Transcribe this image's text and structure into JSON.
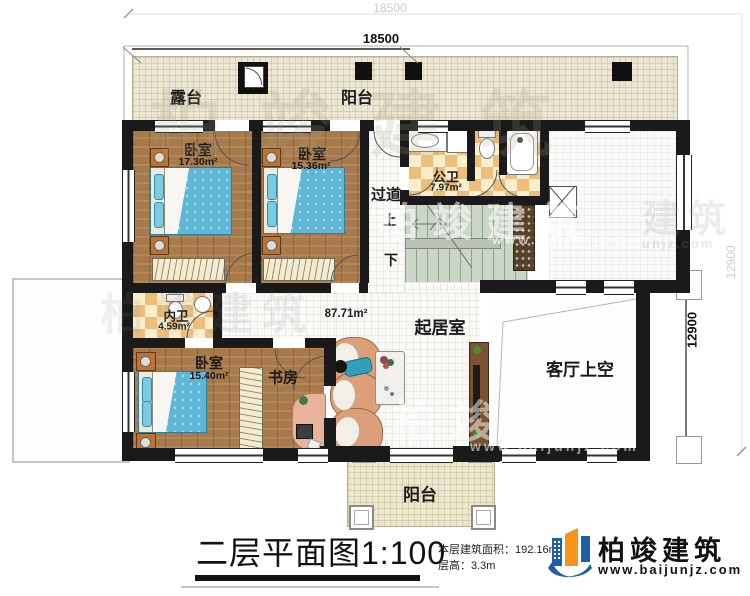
{
  "dimensions": {
    "top_outer": "18500",
    "top_inner": "18500",
    "right_outer": "12900",
    "right_inner": "12900"
  },
  "rooms": {
    "terrace": {
      "label": "露台"
    },
    "balcony_top": {
      "label": "阳台"
    },
    "bedroom1": {
      "label": "卧室",
      "area": "17.30m²"
    },
    "bedroom2": {
      "label": "卧室",
      "area": "15.36m²"
    },
    "public_bath": {
      "label": "公卫",
      "area": "7.97m²"
    },
    "corridor": {
      "label": "过道",
      "stairs_up": "上",
      "stairs_down": "下"
    },
    "private_bath": {
      "label": "内卫",
      "area": "4.59m²"
    },
    "bedroom3": {
      "label": "卧室",
      "area": "15.40m²"
    },
    "study": {
      "label": "书房"
    },
    "living": {
      "label": "起居室",
      "area": "87.71m²"
    },
    "living_void": {
      "label": "客厅上空"
    },
    "balcony_bottom": {
      "label": "阳台"
    }
  },
  "title_block": {
    "title": "二层平面图1:100",
    "floor_area": "本层建筑面积：192.16m²",
    "floor_height": "层高：3.3m",
    "brand": "柏竣建筑",
    "website": "www.baijunjz.com"
  },
  "watermark": {
    "brand": "柏竣建筑",
    "website": "www.baijunjz.com",
    "brand_partial": "建筑",
    "website_partial": "unjz.com"
  },
  "colors": {
    "wall": "#1a1a1a",
    "wood": "#a87a4b",
    "checker": "#ecbe7a",
    "deck": "#ece7d0",
    "bed": "#5fb7d8",
    "sofa": "#dba07a",
    "brand_blue": "#1f5fa8",
    "brand_orange": "#f7941d"
  }
}
